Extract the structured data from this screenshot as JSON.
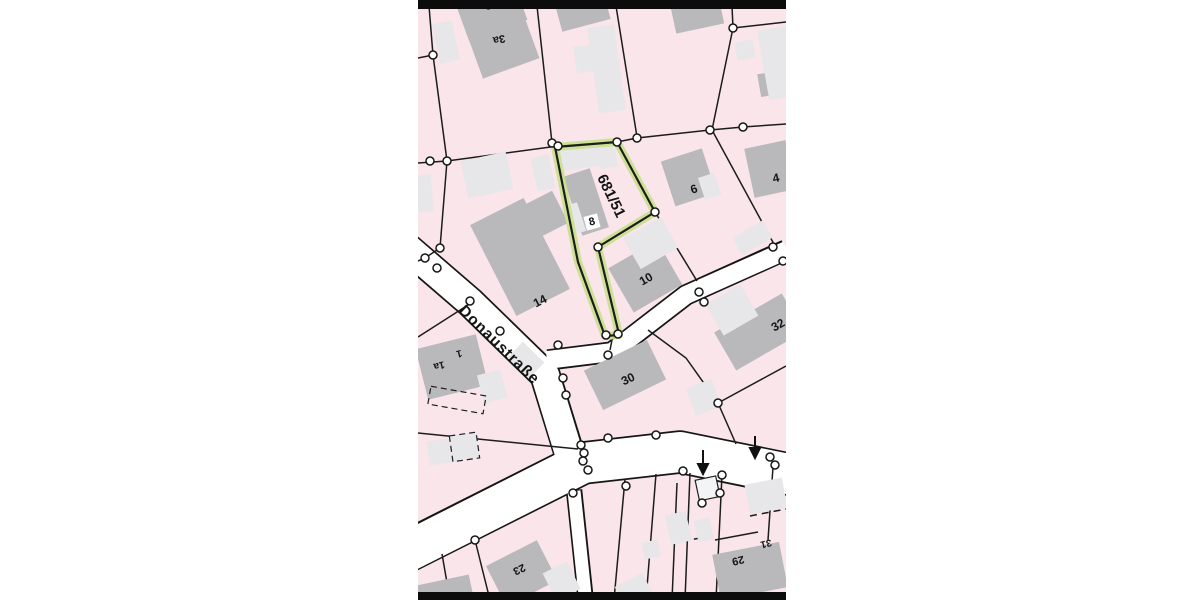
{
  "map": {
    "highlighted_parcel": {
      "label": "681/51"
    },
    "street": {
      "name": "Donaustraße"
    },
    "house_numbers": {
      "h1": "1",
      "h1a": "1a",
      "h3": "3",
      "h3a": "3a",
      "h4": "4",
      "h6": "6",
      "h8": "8",
      "h10": "10",
      "h14": "14",
      "h23": "23",
      "h29": "29",
      "h30": "30",
      "h31": "31",
      "h32": "32"
    },
    "colors": {
      "parcel_fill": "#f9e5ea",
      "building_dark": "#b9b8ba",
      "building_light": "#e7e6e8",
      "building_white": "#f4f3f5",
      "street_fill": "#ffffff",
      "boundary": "#1c1c1c",
      "highlight_glow": "#c8e08d",
      "frame_bar": "#0c0c0c",
      "margin": "#ffffff"
    }
  }
}
